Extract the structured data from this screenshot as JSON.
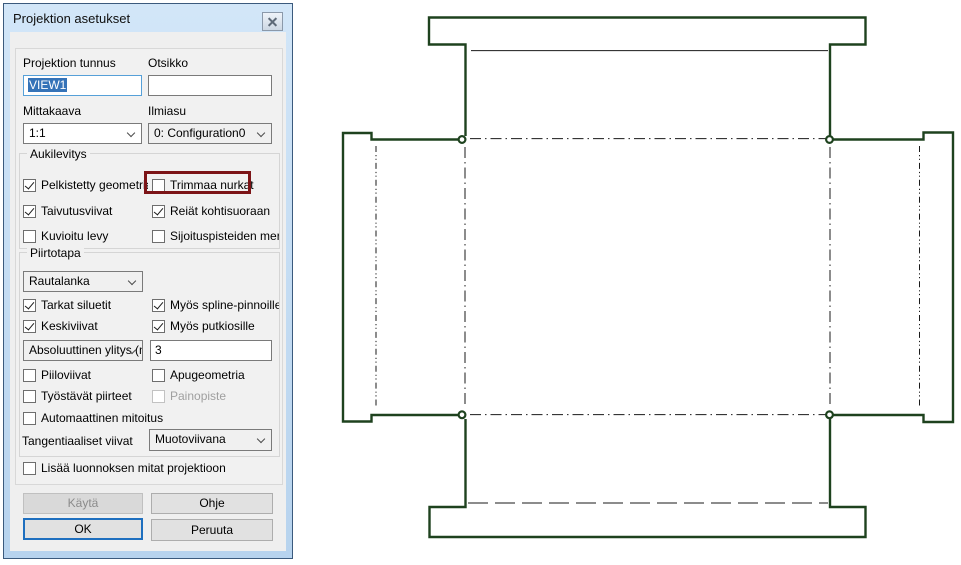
{
  "window": {
    "title": "Projektion asetukset"
  },
  "form": {
    "projektion_tunnus": {
      "label": "Projektion tunnus",
      "value": "VIEW1"
    },
    "otsikko": {
      "label": "Otsikko",
      "value": ""
    },
    "mittakaava": {
      "label": "Mittakaava",
      "value": "1:1"
    },
    "ilmiasu": {
      "label": "Ilmiasu",
      "value": "0: Configuration0"
    }
  },
  "aukilevitys": {
    "legend": "Aukilevitys",
    "items": [
      {
        "label": "Pelkistetty geometria",
        "checked": true,
        "disabled": false
      },
      {
        "label": "Trimmaa nurkat",
        "checked": false,
        "disabled": false,
        "highlighted": true
      },
      {
        "label": "Taivutusviivat",
        "checked": true,
        "disabled": false
      },
      {
        "label": "Reiät kohtisuoraan",
        "checked": true,
        "disabled": false
      },
      {
        "label": "Kuvioitu levy",
        "checked": false,
        "disabled": false
      },
      {
        "label": "Sijoituspisteiden merkir",
        "checked": false,
        "disabled": false
      }
    ]
  },
  "piirtotapa": {
    "legend": "Piirtotapa",
    "drawmode_value": "Rautalanka",
    "items": [
      {
        "label": "Tarkat siluetit",
        "checked": true,
        "disabled": false
      },
      {
        "label": "Myös spline-pinnoille",
        "checked": true,
        "disabled": false
      },
      {
        "label": "Keskiviivat",
        "checked": true,
        "disabled": false
      },
      {
        "label": "Myös putkiosille",
        "checked": true,
        "disabled": false
      },
      {
        "label": "Piiloviivat",
        "checked": false,
        "disabled": false
      },
      {
        "label": "Apugeometria",
        "checked": false,
        "disabled": false
      },
      {
        "label": "Työstävät piirteet",
        "checked": false,
        "disabled": false
      },
      {
        "label": "Painopiste",
        "checked": false,
        "disabled": true
      },
      {
        "label": "Automaattinen mitoitus",
        "checked": false,
        "disabled": false
      }
    ],
    "ylitys_value": "Absoluuttinen ylitys (n",
    "ylitys_amount": "3",
    "tangent_label": "Tangentiaaliset viivat",
    "tangent_value": "Muotoviivana"
  },
  "extra": {
    "lisaa_label": "Lisää luonnoksen mitat projektioon",
    "checked": false
  },
  "buttons": {
    "kayta": "Käytä",
    "ohje": "Ohje",
    "ok": "OK",
    "peruuta": "Peruuta"
  },
  "colors": {
    "titlebar_top": "#d2e6f8",
    "titlebar_bottom": "#b7d3ee",
    "highlight_box": "#7c1417",
    "selection_blue": "#3573b8",
    "outline_green": "#1e421e",
    "thin_line": "#1a1a1a",
    "default_button_border": "#1e6fbf"
  },
  "drawing": {
    "description": "Sheet metal flat pattern of a box: central panel with four flaps and edge lips, bend lines shown as dash-dot lines, corner reliefs at the four panel corners",
    "outline_style": "thick dark green",
    "bend_line_style": "thin black dash-dot"
  }
}
